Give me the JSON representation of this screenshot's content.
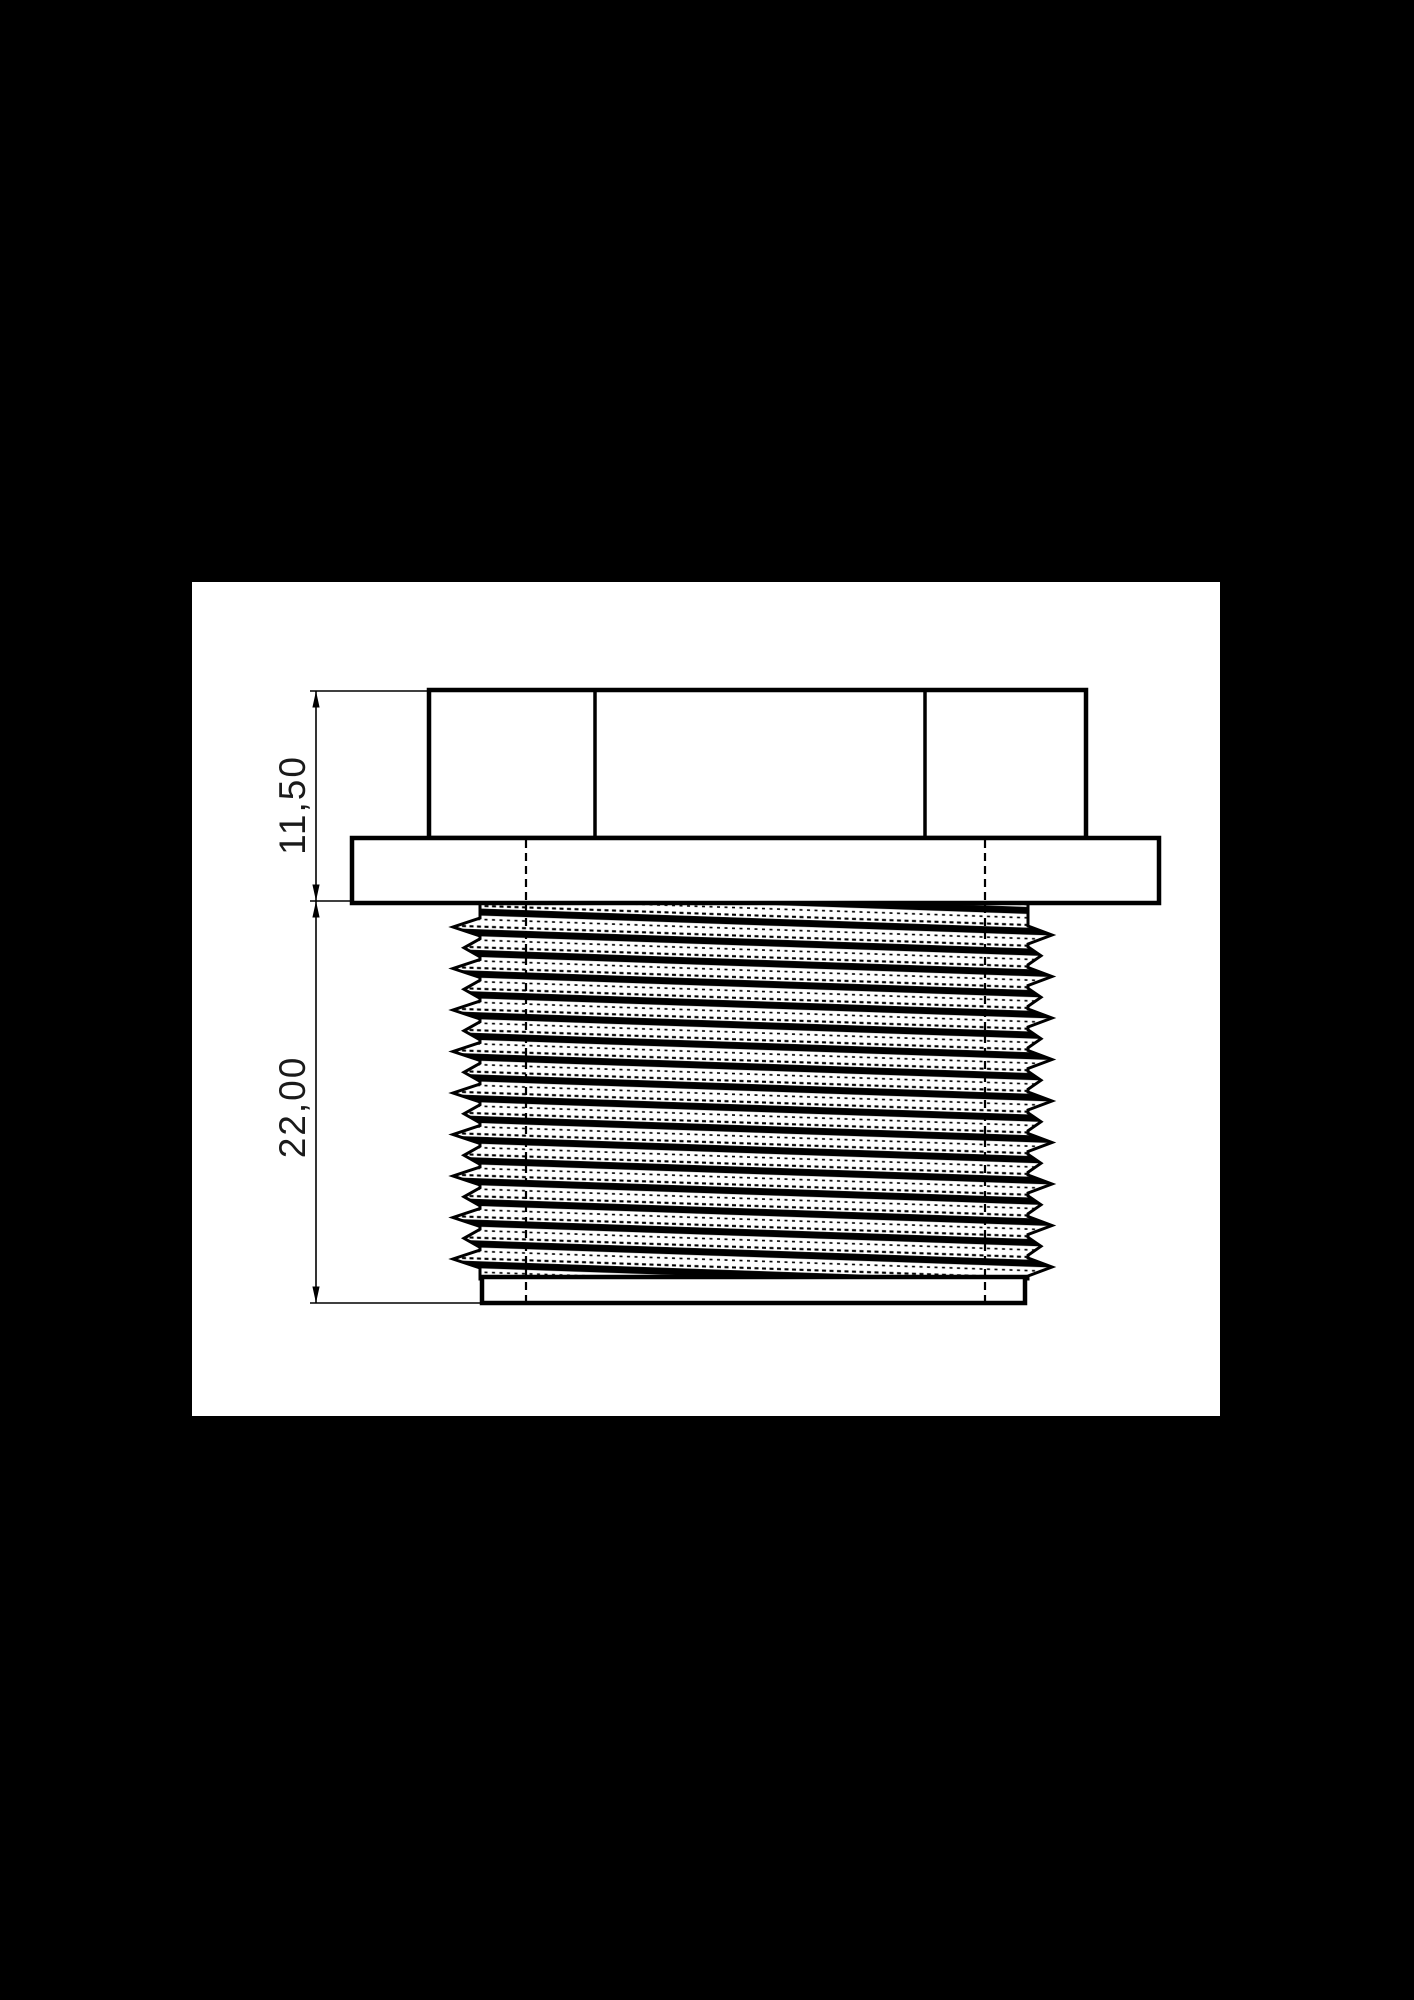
{
  "colors": {
    "background": "#000000",
    "paper": "#ffffff",
    "line": "#000000"
  },
  "drawing": {
    "part_description": "side view of hex-head threaded plug",
    "dimension_labels": {
      "head_height": "11,50",
      "thread_length": "22,00"
    }
  }
}
